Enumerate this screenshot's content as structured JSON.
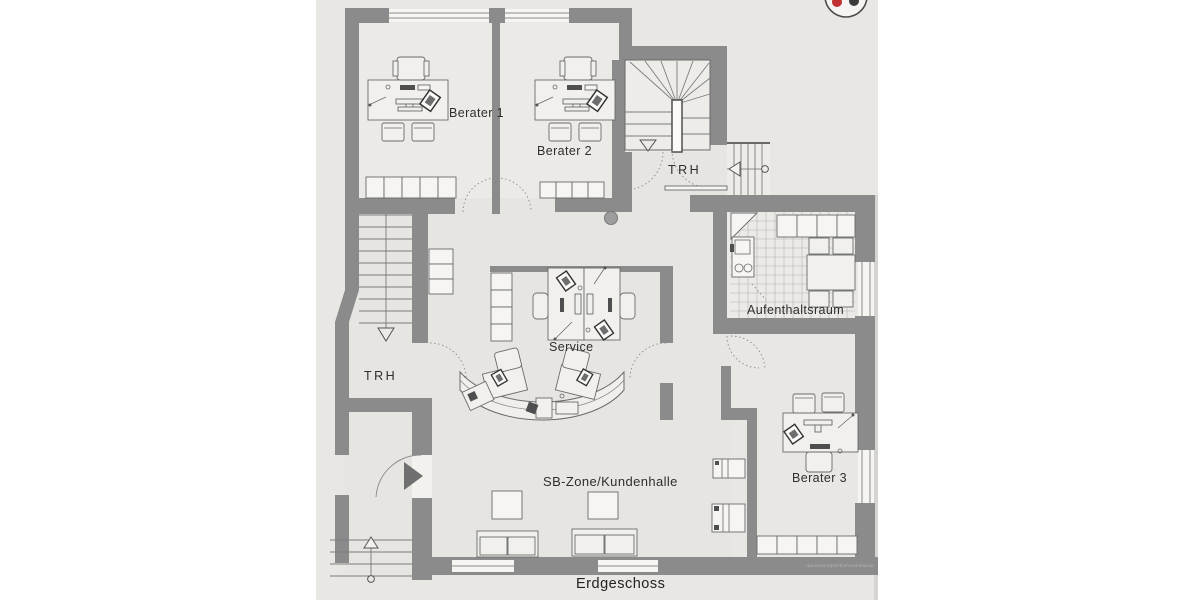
{
  "plan": {
    "floor_label": "Erdgeschoss",
    "watermark": "raumkonzepte/kommunikation",
    "rooms": {
      "berater1": {
        "label": "Berater 1"
      },
      "berater2": {
        "label": "Berater 2"
      },
      "berater3": {
        "label": "Berater 3"
      },
      "service": {
        "label": "Service"
      },
      "aufenthaltsraum": {
        "label": "Aufenthaltsraum"
      },
      "trh_upper": {
        "label": "TRH"
      },
      "trh_lower": {
        "label": "TRH"
      },
      "sb_zone": {
        "label": "SB-Zone/Kundenhalle"
      }
    },
    "colors": {
      "wall": "#8b8b8b",
      "paper": "#e9e7e3",
      "interior": "#e7e5e1",
      "room_light": "#edecE8",
      "logo_red": "#c03030",
      "logo_dark": "#3a3a3a"
    }
  }
}
